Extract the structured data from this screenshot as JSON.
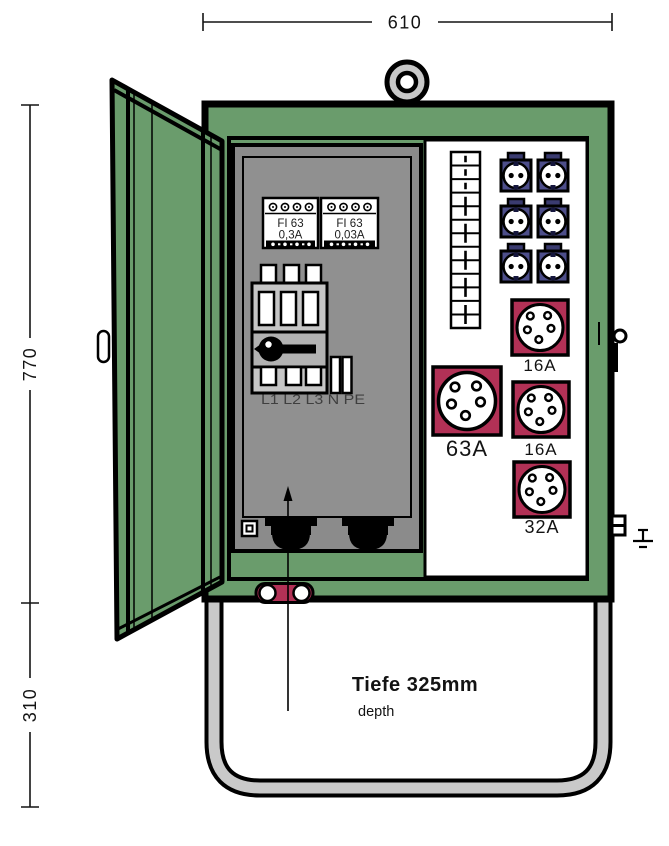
{
  "diagram": {
    "title_note": "distribution cabinet front view",
    "labels": {
      "dim_width": "610",
      "dim_height": "770",
      "dim_stand": "310",
      "depth_line1": "Tiefe 325mm",
      "depth_line2": "depth",
      "phases": "L1 L2 L3 N PE"
    },
    "rcd_blocks": [
      {
        "line1": "FI 63",
        "line2": "0,3A"
      },
      {
        "line1": "FI 63",
        "line2": "0,03A"
      }
    ],
    "cee_sockets": [
      {
        "label": "16A",
        "size": "small"
      },
      {
        "label": "63A",
        "size": "large"
      },
      {
        "label": "16A",
        "size": "small"
      },
      {
        "label": "32A",
        "size": "small"
      }
    ],
    "schuko_sockets": {
      "count": 6,
      "rows": 3,
      "cols": 2
    },
    "breaker_strip": {
      "modules": 13
    },
    "colors": {
      "cabinet_green": "#6a9c6c",
      "panel_gray": "#8b8b8b",
      "plate_gray": "#909090",
      "switch_gray": "#c6c6c6",
      "switch_mid_gray": "#b2b2b2",
      "socket_blue": "#4d4e8a",
      "socket_blue_dark": "#3a3b70",
      "cee_red": "#b23156",
      "stand_gray": "#c9c9c9",
      "outline": "#000000"
    }
  }
}
